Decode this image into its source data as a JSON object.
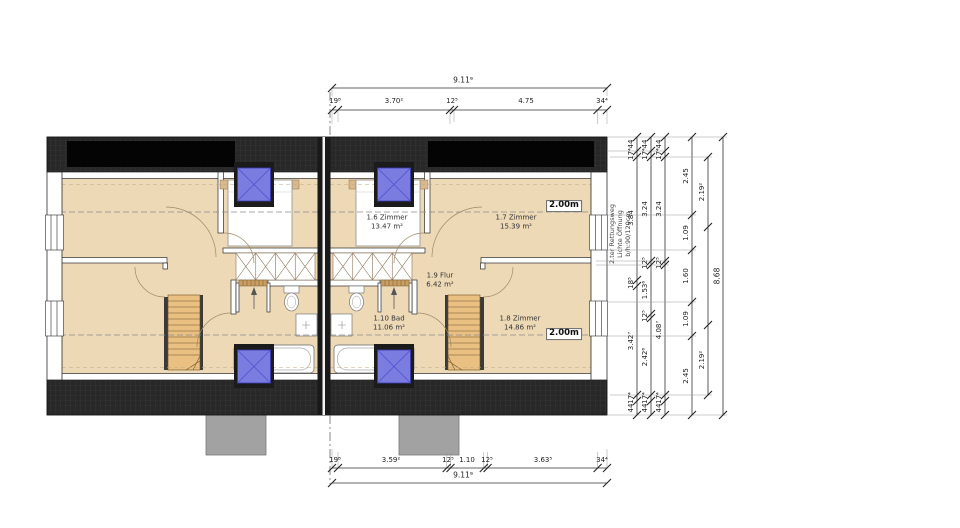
{
  "drawing": {
    "rooms": [
      {
        "name": "1.6 Zimmer",
        "area": "13.47 m²"
      },
      {
        "name": "1.7 Zimmer",
        "area": "15.39 m²"
      },
      {
        "name": "1.8 Zimmer",
        "area": "14.86 m²"
      },
      {
        "name": "1.9 Flur",
        "area": "6.42 m²"
      },
      {
        "name": "1.10 Bad",
        "area": "11.06 m²"
      }
    ],
    "height_label": "2.00m",
    "note_lines": [
      "2.ter Rettungsweg",
      "Lichte Öffnung",
      "b/h:90/120cm"
    ]
  },
  "dims": {
    "top": {
      "total": "9.11⁹",
      "segs": [
        "19⁸",
        "3.70²",
        "12⁵",
        "4.75",
        "34⁴"
      ]
    },
    "bottom": {
      "total": "9.11⁹",
      "segs": [
        "19⁸",
        "3.59²",
        "12⁵",
        "1.10",
        "12⁵",
        "3.63⁵",
        "34⁴"
      ]
    },
    "right": {
      "c1": [
        "44",
        "17⁴",
        "3.84",
        "18⁵",
        "3.42⁷",
        "17⁴",
        "44"
      ],
      "c2": [
        "44",
        "17⁴",
        "3.24",
        "12⁵",
        "1.53⁶",
        "12⁵",
        "2.42⁶",
        "17⁴",
        "44"
      ],
      "c3": [
        "44",
        "17⁴",
        "3.24",
        "12⁵",
        "4.08⁷",
        "17⁴",
        "44"
      ],
      "c4": [
        "2.45",
        "1.09",
        "1.60",
        "1.09",
        "2.45"
      ],
      "c5": [
        "2.19²",
        "2.19²"
      ],
      "total": "8.68"
    }
  },
  "colors": {
    "floor": "#eed9b7",
    "roof_band": "#282828",
    "solar_panel": "#040404",
    "roof_window_blue": "#7b7ce0",
    "stair_wood": "#eabf82"
  }
}
